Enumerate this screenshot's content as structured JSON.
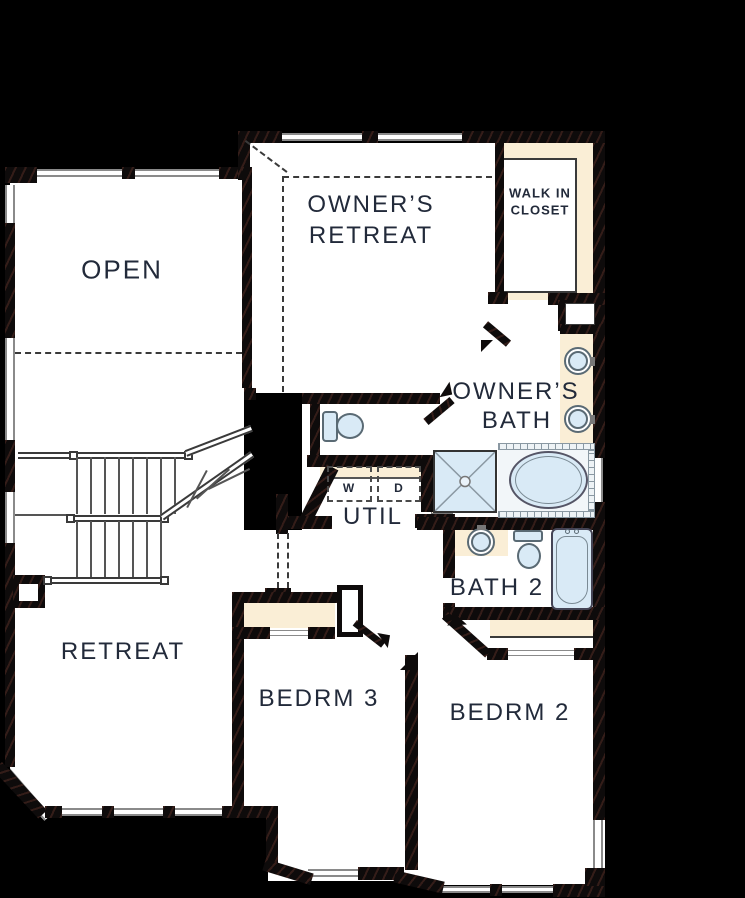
{
  "rooms": {
    "open": {
      "label": "OPEN"
    },
    "owners_retreat": {
      "line1": "OWNER’S",
      "line2": "RETREAT"
    },
    "walk_in_closet": {
      "line1": "WALK IN",
      "line2": "CLOSET"
    },
    "owners_bath": {
      "line1": "OWNER’S",
      "line2": "BATH"
    },
    "util": {
      "label": "UTIL"
    },
    "bath2": {
      "label": "BATH 2"
    },
    "retreat": {
      "label": "RETREAT"
    },
    "bedrm3": {
      "label": "BEDRM 3"
    },
    "bedrm2": {
      "label": "BEDRM 2"
    }
  },
  "appliances": {
    "washer": "W",
    "dryer": "D"
  },
  "colors": {
    "background": "#000000",
    "floor": "#ffffff",
    "wall": "#0e0b0b",
    "accent_beige": "#faeed6",
    "fixture_blue": "#d9eaf6",
    "label_text": "#222a3a",
    "window_line": "#8a8a8a"
  }
}
